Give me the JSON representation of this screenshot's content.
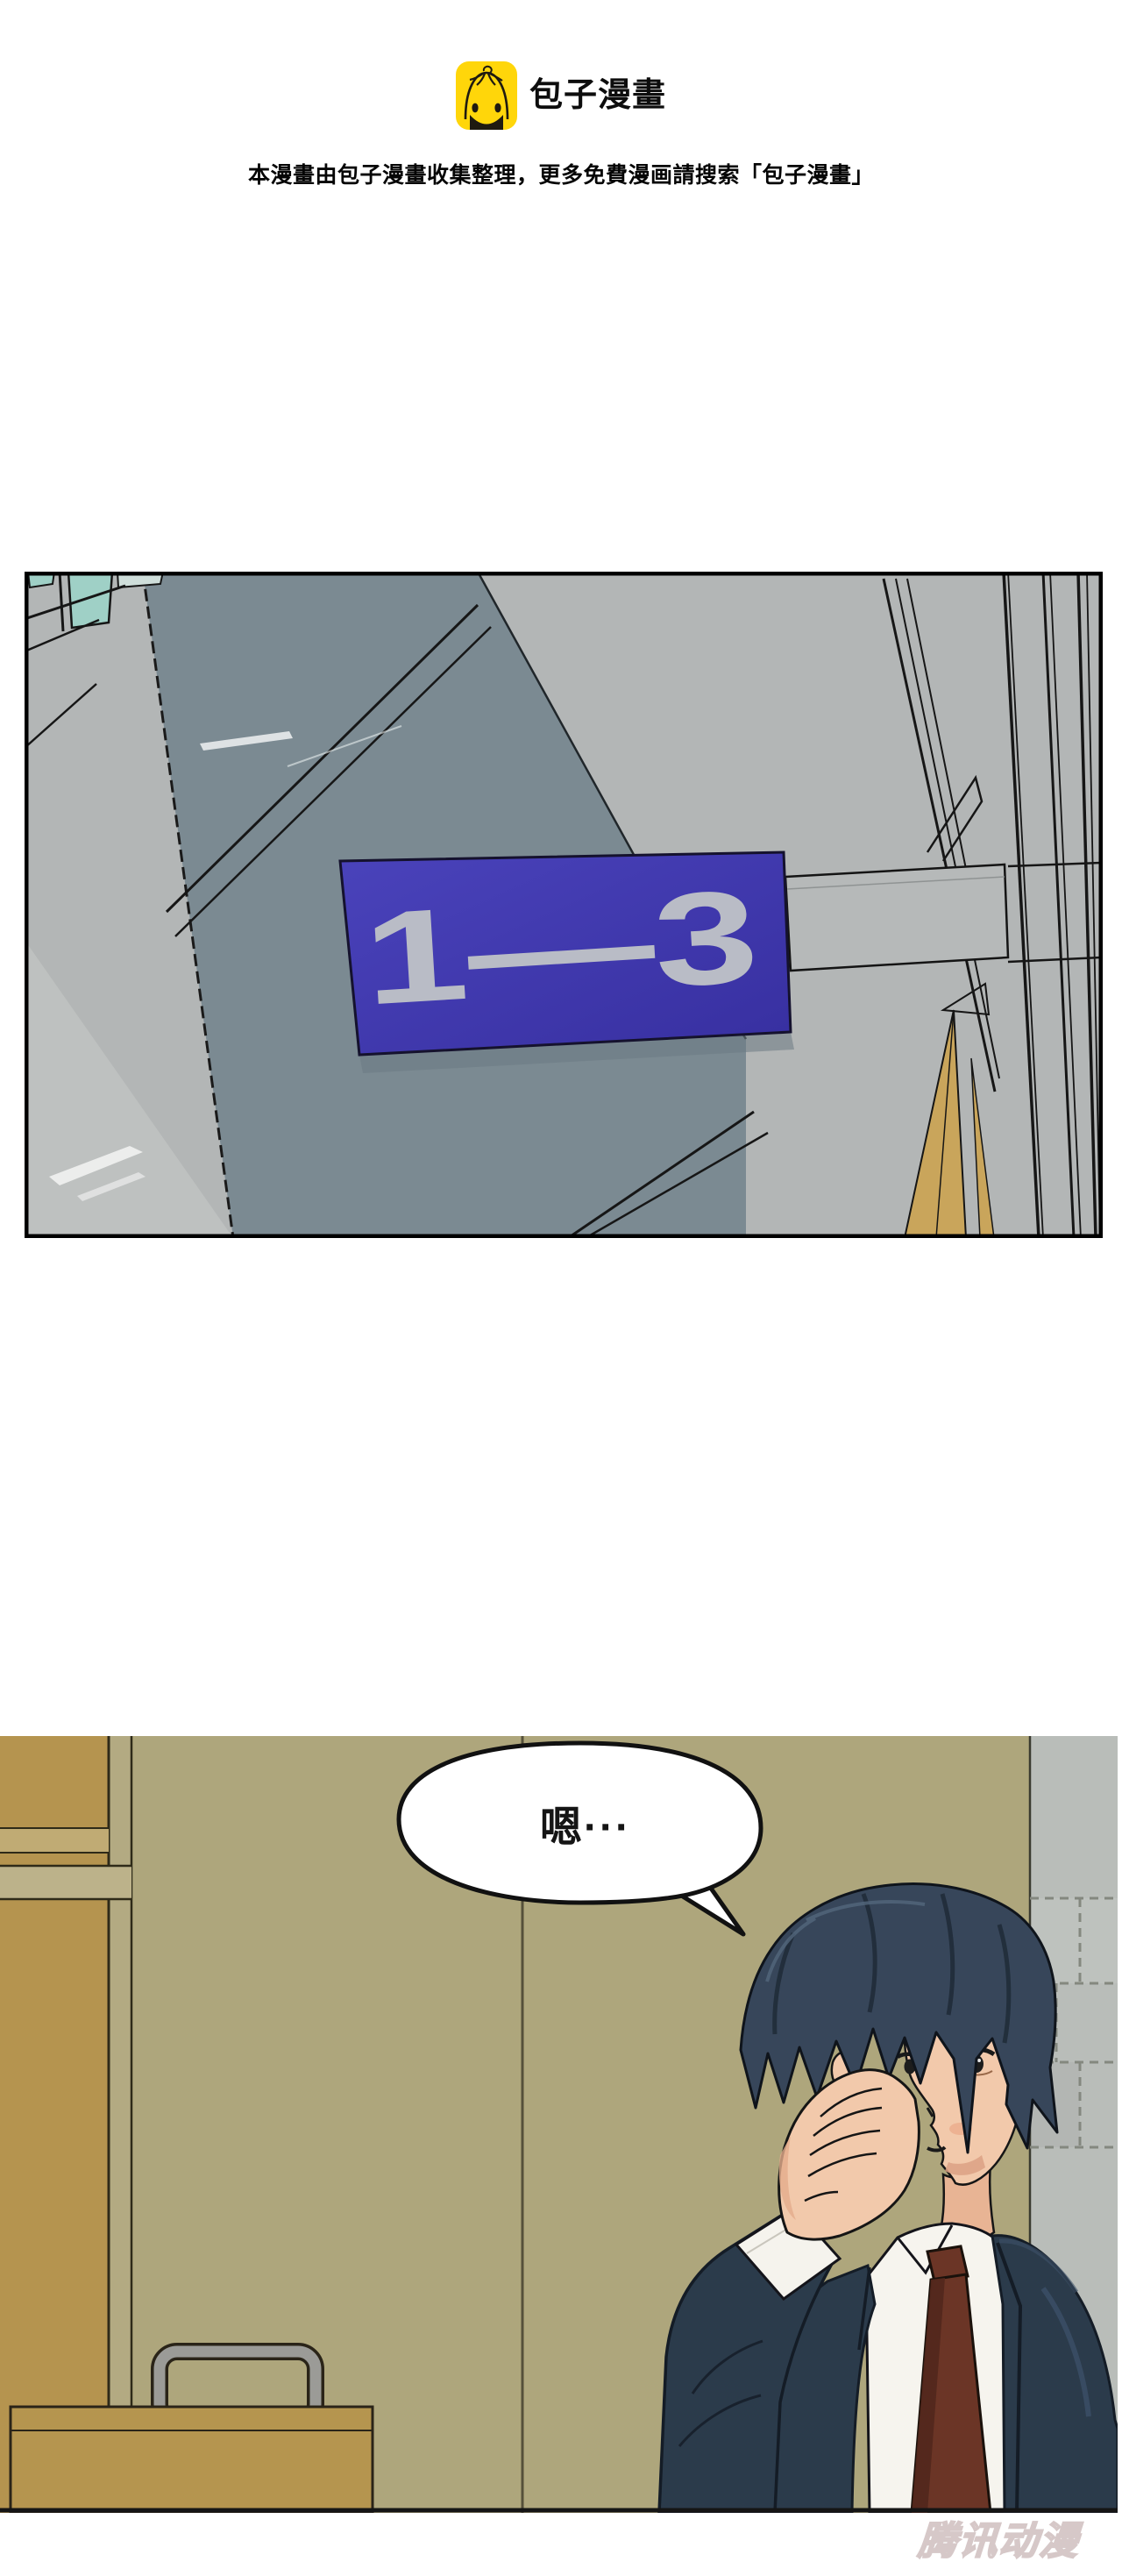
{
  "header": {
    "brand": "包子漫畫",
    "logo_icon": "baozi-bun-face-icon",
    "notice": "本漫畫由包子漫畫收集整理，更多免費漫画請搜索「包子漫畫」"
  },
  "panel1": {
    "name": "corridor-scene",
    "sign_text": "1—3",
    "sign_color": "#4038ae",
    "sign_text_color": "#b9bcc6",
    "wall_slate": "#7b8a92",
    "wall_gray": "#b3b6b6",
    "window_teal": "#9fd0c6",
    "wedge_yellow": "#c9a55b"
  },
  "panel2": {
    "name": "office-scene",
    "speech_text": "嗯···",
    "wall_olive": "#aea67c",
    "cabinet_tan": "#b5944f",
    "brick_gray": "#b9bdb9",
    "suit_navy": "#2b3b4b",
    "tie_maroon": "#6b3526"
  },
  "watermark": {
    "text": "腾讯动漫"
  }
}
